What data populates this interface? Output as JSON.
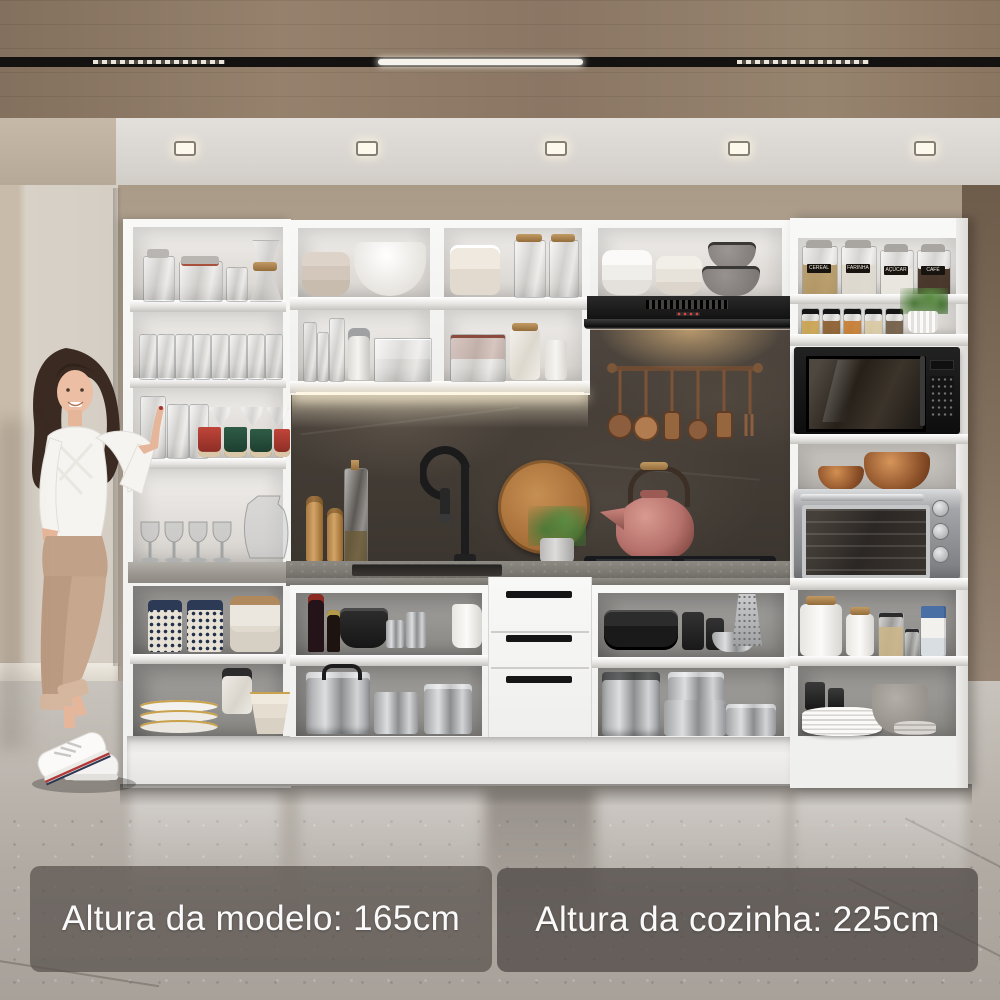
{
  "overlay": {
    "badges": [
      {
        "label": "Altura da modelo: 165cm"
      },
      {
        "label": "Altura da cozinha: 225cm"
      }
    ]
  },
  "pantry_jars": {
    "labels": [
      "CEREAL",
      "FARINHA",
      "AÇÚCAR",
      "CAFÉ"
    ]
  },
  "palette": {
    "wood_ceiling": "#8d7663",
    "ceiling_white": "#ddd9d4",
    "hall_wall": "#d7d0c6",
    "back_wall": "#b3a593",
    "right_wall": "#7b6a5c",
    "cabinet_white": "#f6f6f5",
    "backsplash_slate": "#48413a",
    "countertop_gray": "#827e78",
    "floor_gray": "#b7b1ab",
    "badge_bg": "rgba(84,77,73,0.75)",
    "badge_text": "#fbfafa",
    "copper": "#9a6a46",
    "kettle_rose": "#b5706b",
    "led_warm": "#f5ead0"
  }
}
